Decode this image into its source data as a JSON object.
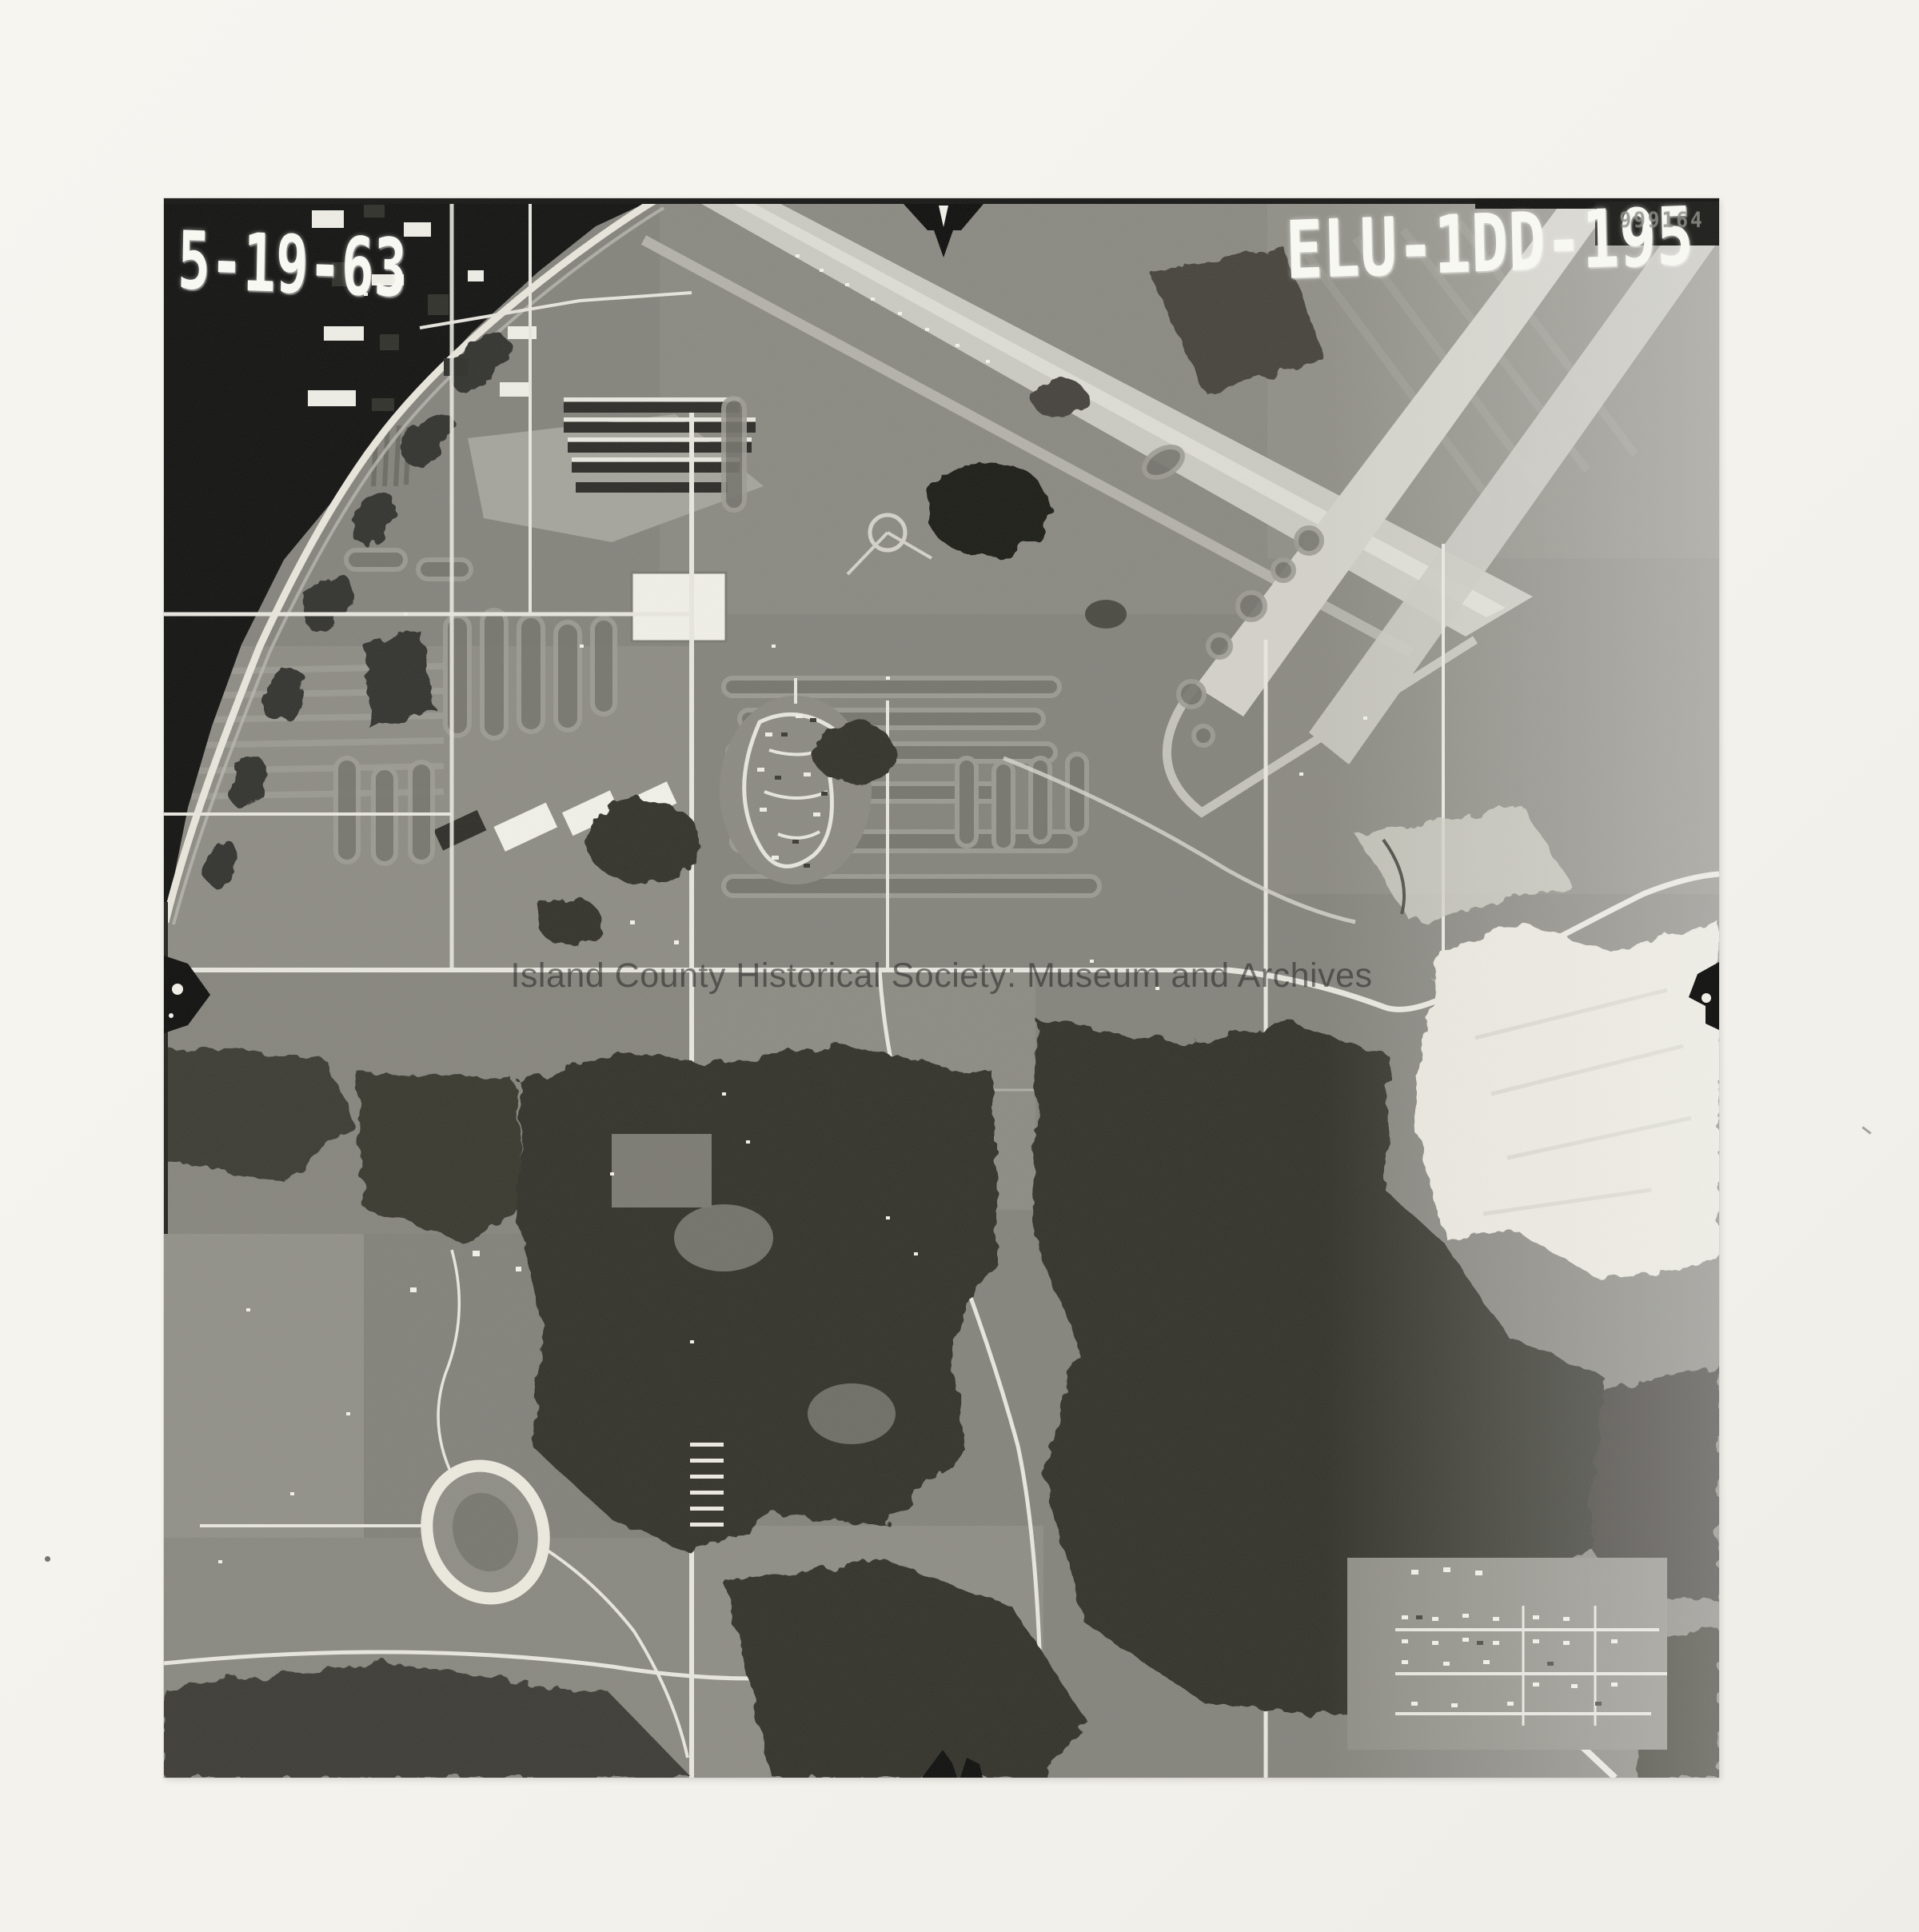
{
  "photo": {
    "date_label": "5-19-63",
    "photo_id": "ELU-1DD-195",
    "corner_stamp": "999164",
    "watermark": "Island County Historical Society: Museum and Archives"
  },
  "colors": {
    "paper": "#f5f3ee",
    "photo_base": "#84837c",
    "water": "#121211",
    "forest": "#32312b",
    "road": "#e8e7df",
    "runway": "#cbcac2",
    "clearing": "#e9e7dd",
    "label_white": "#f8f8f3",
    "watermark_gray": "#2a2a2a"
  },
  "icons": {
    "fiducial_top": "fiducial-arrow-down-icon",
    "fiducial_left": "fiducial-arrow-right-icon",
    "fiducial_right": "fiducial-arrow-left-icon",
    "fiducial_bottom": "fiducial-arrow-up-icon"
  }
}
